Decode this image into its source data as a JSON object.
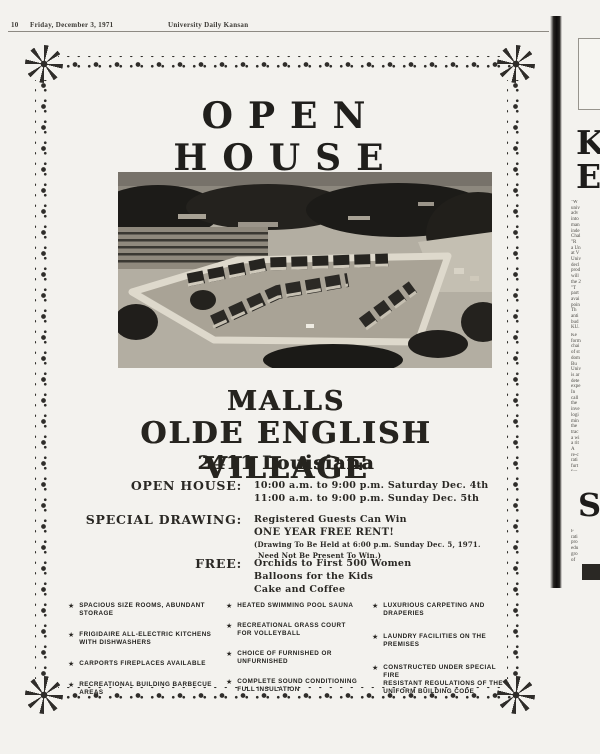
{
  "header": {
    "page_number": "10",
    "date": "Friday, December 3, 1971",
    "paper": "University Daily Kansan"
  },
  "icons": {
    "star": "★"
  },
  "colors": {
    "ink": "#201f1c",
    "paper": "#f3f2ee",
    "fold_rule": "#0e0d0c"
  },
  "ad": {
    "title": "OPEN HOUSE",
    "venue_line1": "MALLS",
    "venue_line2": "OLDE ENGLISH VILLAGE",
    "venue_address": "2411 Louisiana",
    "open_house": {
      "label": "OPEN HOUSE:",
      "line1": "10:00 a.m. to 9:00 p.m. Saturday Dec. 4th",
      "line2": "11:00 a.m. to 9:00 p.m. Sunday Dec. 5th"
    },
    "special_drawing": {
      "label": "SPECIAL DRAWING:",
      "line1": "Registered Guests Can Win",
      "line2": "ONE YEAR FREE RENT!",
      "line3": "(Drawing To Be Held at 6:00 p.m. Sunday Dec. 5, 1971.",
      "line4": "Need Not Be Present To Win.)"
    },
    "free": {
      "label": "FREE:",
      "line1": "Orchids to First 500 Women",
      "line2": "Balloons for the Kids",
      "line3": "Cake and Coffee"
    },
    "features_col1": [
      "SPACIOUS SIZE ROOMS, ABUNDANT STORAGE",
      "FRIGIDAIRE ALL-ELECTRIC KITCHENS\nWITH DISHWASHERS",
      "CARPORTS FIREPLACES AVAILABLE",
      "RECREATIONAL BUILDING BARBECUE AREAS"
    ],
    "features_col2": [
      "HEATED SWIMMING POOL SAUNA",
      "RECREATIONAL GRASS COURT\nFOR VOLLEYBALL",
      "CHOICE OF FURNISHED OR UNFURNISHED",
      "COMPLETE SOUND CONDITIONING\nFULL INSULATION"
    ],
    "features_col3": [
      "LUXURIOUS CARPETING AND DRAPERIES",
      "LAUNDRY FACILITIES ON THE PREMISES",
      "CONSTRUCTED UNDER SPECIAL FIRE\nRESISTANT REGULATIONS OF THE\nUNIFORM BUILDING CODE"
    ]
  },
  "side_column": {
    "headline_letter1": "K",
    "headline_letter2": "E",
    "drop_cap": "S",
    "fragments_top": "\"W\nuniv\nadv\ninto\nman\ninde\nChal\n\"R\na Un\nat V\nUniv\ndecl\nprod\nwill\nthe 2\n\"T\npart\navai\npoin\nTh\nanti\nbud\nKU.",
    "fragments_mid": "Ke\nform\nchai\nof st\ndom\nBu\nUniv\nis ar\ndete\nexpe\nIn\ncall\nthe\ninve\nlogi\nmin\nthe\ntrac\na wi\na rit\nA\nre-c\nrati\nfurt\nfun\ngro",
    "fragments_bottom": "F\nrati\npro\nedu\ngro\nof"
  }
}
